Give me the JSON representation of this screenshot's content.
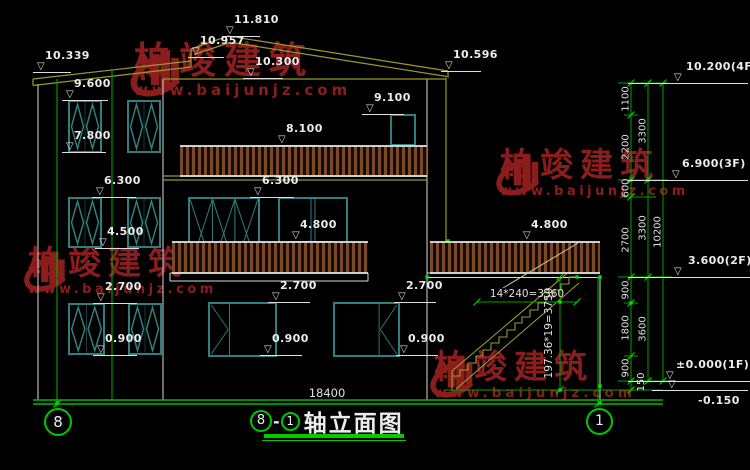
{
  "watermark": {
    "brand": "柏竣建筑",
    "url": "www.baijunjz.com",
    "color": "#8b1d1d"
  },
  "colors": {
    "background": "#000000",
    "wall_lines": "#d9d9d9",
    "roof_lines": "#9a9a30",
    "window_frames": "#2f7f7f",
    "railing_slats": "#7a4a28",
    "dim_lines": "#00a400",
    "ticks": "#00d400",
    "axis_green": "#00b400",
    "text_white": "#ececec"
  },
  "markers": [
    {
      "label": "10.339"
    },
    {
      "label": "11.810"
    },
    {
      "label": "10.957"
    },
    {
      "label": "10.300"
    },
    {
      "label": "10.596"
    },
    {
      "label": "9.600"
    },
    {
      "label": "7.800"
    },
    {
      "label": "6.300"
    },
    {
      "label": "4.500"
    },
    {
      "label": "2.700"
    },
    {
      "label": "0.900"
    },
    {
      "label": "8.100"
    },
    {
      "label": "9.100"
    },
    {
      "label": "6.300"
    },
    {
      "label": "4.800"
    },
    {
      "label": "2.700"
    },
    {
      "label": "0.900"
    },
    {
      "label": "2.700"
    },
    {
      "label": "0.900"
    },
    {
      "label": "4.800"
    }
  ],
  "right_markers": [
    {
      "label": "10.200(4F)"
    },
    {
      "label": "6.900(3F)"
    },
    {
      "label": "3.600(2F)"
    },
    {
      "label": "±0.000(1F)"
    },
    {
      "label": "-0.150"
    }
  ],
  "dims": {
    "col1": [
      "1100",
      "2200",
      "600",
      "2700",
      "900",
      "1800",
      "900",
      "150"
    ],
    "col2": [
      "3300",
      "3300",
      "3600"
    ],
    "col3": [
      "10200"
    ],
    "bottom": "18400",
    "stair_horizontal": "14*240=3360",
    "stair_vertical": "197.36*19=3750"
  },
  "axes": {
    "left_bubble": "8",
    "right_bubble": "1"
  },
  "title": {
    "axis_left": "8",
    "separator": "-",
    "axis_right": "1",
    "name": "轴立面图"
  }
}
